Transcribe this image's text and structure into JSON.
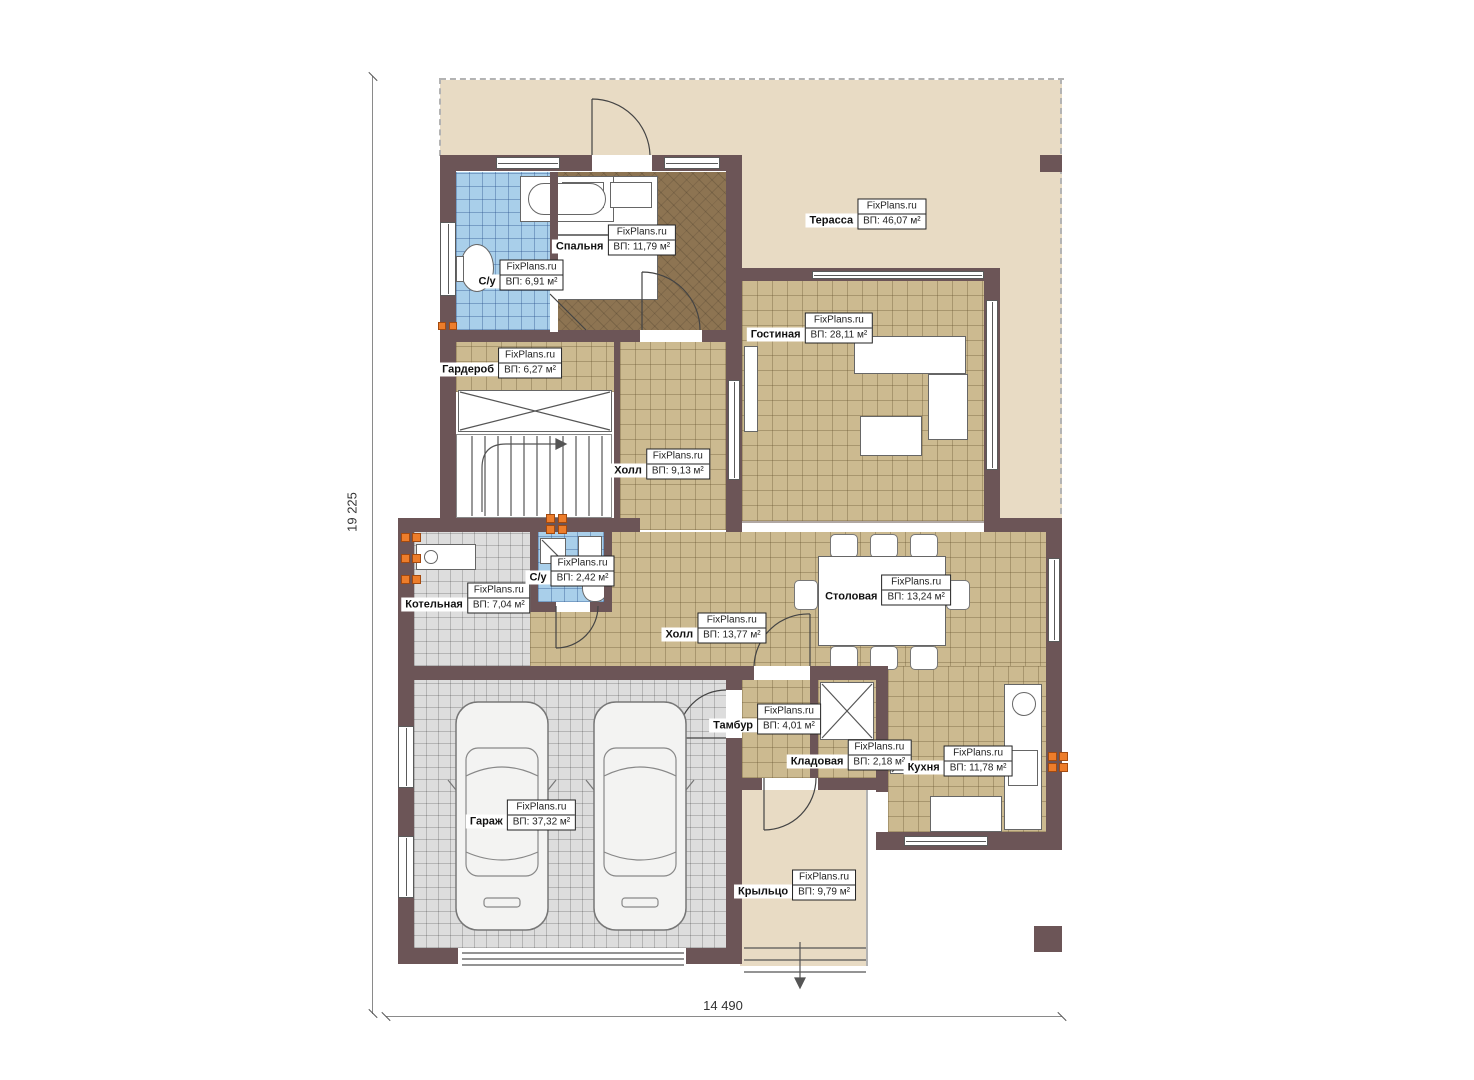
{
  "title": "План первого этажа",
  "watermark": "FixPlans.ru",
  "dimensions": {
    "left": "19 225",
    "bottom": "14 490"
  },
  "colors": {
    "wall": "#6c5557",
    "floor_tan": "#ccba90",
    "floor_gray": "#dddddd",
    "floor_blue": "#a9cfea",
    "floor_bedroom": "#8d7452",
    "terrace": "#e8dbc4",
    "socket_marker": "#ed7d2b"
  },
  "rooms": [
    {
      "id": "terrace",
      "name": "Терасса",
      "area": "ВП: 46,07 м²",
      "floor": "terrace",
      "floors": [
        [
          440,
          80,
          622,
          76
        ],
        [
          742,
          155,
          320,
          114
        ],
        [
          998,
          268,
          64,
          253
        ]
      ],
      "label": [
        866,
        214
      ]
    },
    {
      "id": "living",
      "name": "Гостиная",
      "area": "ВП: 28,11 м²",
      "floor": "tan",
      "floors": [
        [
          742,
          281,
          242,
          240
        ]
      ],
      "label": [
        810,
        328
      ]
    },
    {
      "id": "bedroom",
      "name": "Спальня",
      "area": "ВП: 11,79 м²",
      "floor": "brown",
      "floors": [
        [
          556,
          172,
          172,
          158
        ]
      ],
      "label": [
        614,
        240
      ]
    },
    {
      "id": "bath1",
      "name": "С/у",
      "area": "ВП: 6,91 м²",
      "floor": "blue",
      "floors": [
        [
          456,
          172,
          96,
          158
        ]
      ],
      "label": [
        519,
        275
      ]
    },
    {
      "id": "wardrobe",
      "name": "Гардероб",
      "area": "ВП: 6,27 м²",
      "floor": "tan",
      "floors": [
        [
          456,
          342,
          158,
          50
        ]
      ],
      "label": [
        500,
        363
      ]
    },
    {
      "id": "hall1",
      "name": "Холл",
      "area": "ВП: 9,13 м²",
      "floor": "tan",
      "floors": [
        [
          620,
          342,
          106,
          188
        ]
      ],
      "label": [
        660,
        464
      ]
    },
    {
      "id": "hall2",
      "name": "Холл",
      "area": "ВП: 13,77 м²",
      "floor": "tan",
      "floors": [
        [
          530,
          532,
          516,
          146
        ]
      ],
      "label": [
        714,
        628
      ]
    },
    {
      "id": "dining",
      "name": "Столовая",
      "area": "ВП: 13,24 м²",
      "floor": "tan",
      "floors": [],
      "label": [
        886,
        590
      ]
    },
    {
      "id": "boiler",
      "name": "Котельная",
      "area": "ВП: 7,04 м²",
      "floor": "gray",
      "floors": [
        [
          414,
          532,
          116,
          134
        ]
      ],
      "label": [
        466,
        598
      ]
    },
    {
      "id": "bath2",
      "name": "С/у",
      "area": "ВП: 2,42 м²",
      "floor": "blue",
      "floors": [
        [
          538,
          532,
          66,
          70
        ]
      ],
      "label": [
        570,
        571
      ]
    },
    {
      "id": "tambour",
      "name": "Тамбур",
      "area": "ВП: 4,01 м²",
      "floor": "tan",
      "floors": [
        [
          742,
          680,
          68,
          98
        ]
      ],
      "label": [
        765,
        719
      ]
    },
    {
      "id": "pantry",
      "name": "Кладовая",
      "area": "ВП: 2,18 м²",
      "floor": "tan",
      "floors": [
        [
          818,
          680,
          58,
          98
        ]
      ],
      "label": [
        849,
        755
      ]
    },
    {
      "id": "kitchen",
      "name": "Кухня",
      "area": "ВП: 11,78 м²",
      "floor": "tan",
      "floors": [
        [
          888,
          666,
          158,
          166
        ]
      ],
      "label": [
        958,
        761
      ]
    },
    {
      "id": "garage",
      "name": "Гараж",
      "area": "ВП: 37,32 м²",
      "floor": "gray",
      "floors": [
        [
          414,
          680,
          312,
          268
        ]
      ],
      "label": [
        521,
        815
      ]
    },
    {
      "id": "porch",
      "name": "Крыльцо",
      "area": "ВП: 9,79 м²",
      "floor": "terrace",
      "floors": [
        [
          740,
          790,
          126,
          176
        ]
      ],
      "label": [
        795,
        885
      ]
    }
  ]
}
